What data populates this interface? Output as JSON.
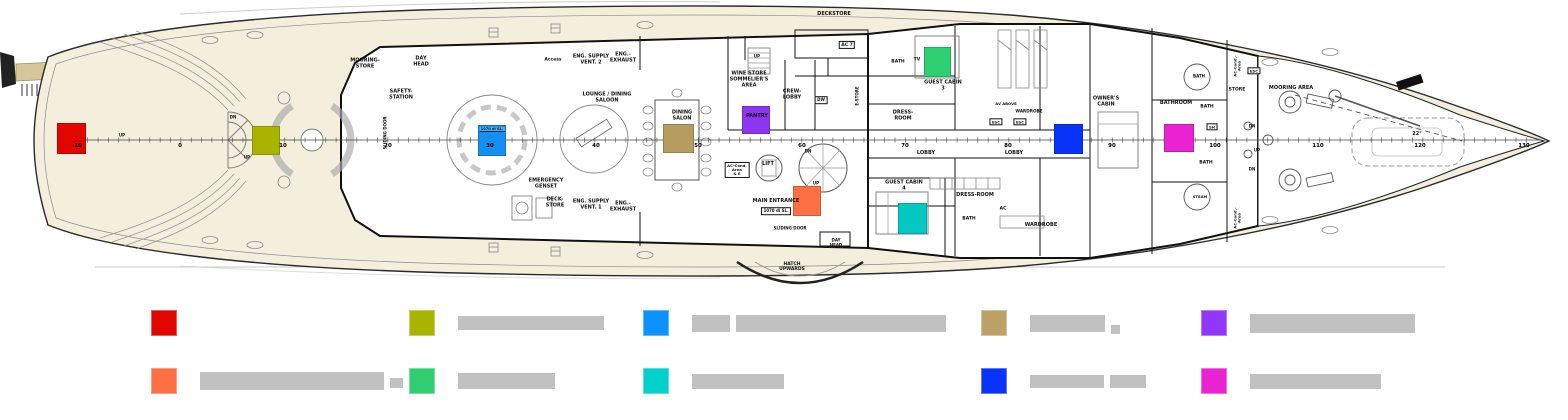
{
  "plan": {
    "deck_color": "#f4eedd",
    "gangway_color": "#d8c69b",
    "frame_numbers": [
      {
        "t": "-10",
        "x": 77
      },
      {
        "t": "0",
        "x": 180
      },
      {
        "t": "10",
        "x": 283
      },
      {
        "t": "20",
        "x": 388
      },
      {
        "t": "30",
        "x": 490
      },
      {
        "t": "40",
        "x": 596
      },
      {
        "t": "50",
        "x": 698
      },
      {
        "t": "60",
        "x": 802
      },
      {
        "t": "70",
        "x": 905
      },
      {
        "t": "80",
        "x": 1008
      },
      {
        "t": "90",
        "x": 1112
      },
      {
        "t": "100",
        "x": 1215
      },
      {
        "t": "110",
        "x": 1318
      },
      {
        "t": "120",
        "x": 1420
      },
      {
        "t": "130",
        "x": 1524
      }
    ],
    "room_labels": [
      {
        "t": "MOORING-\nSTORE",
        "x": 365,
        "y": 64
      },
      {
        "t": "DAY\nHEAD",
        "x": 421,
        "y": 62
      },
      {
        "t": "SAFETY-\nSTATION",
        "x": 401,
        "y": 95
      },
      {
        "t": "SLIDING DOOR",
        "x": 386,
        "y": 133,
        "v": true,
        "s": 4
      },
      {
        "t": "EMERGENCY\nGENSET",
        "x": 546,
        "y": 184
      },
      {
        "t": "Access",
        "x": 553,
        "y": 60,
        "s": 4.5
      },
      {
        "t": "ENG. SUPPLY\nVENT. 2",
        "x": 591,
        "y": 60
      },
      {
        "t": "ENG.-\nEXHAUST",
        "x": 623,
        "y": 58
      },
      {
        "t": "LOUNGE / DINING\nSALOON",
        "x": 607,
        "y": 98
      },
      {
        "t": "DECK-\nSTORE",
        "x": 555,
        "y": 203
      },
      {
        "t": "ENG. SUPPLY\nVENT. 1",
        "x": 591,
        "y": 205
      },
      {
        "t": "ENG.-\nEXHAUST",
        "x": 623,
        "y": 207
      },
      {
        "t": "DINING\nSALON",
        "x": 682,
        "y": 116
      },
      {
        "t": "WINE STORE\nSOMMELIER'S\nAREA",
        "x": 749,
        "y": 80
      },
      {
        "t": "PANTRY",
        "x": 757,
        "y": 117
      },
      {
        "t": "CREW-\nLOBBY",
        "x": 792,
        "y": 95
      },
      {
        "t": "DW",
        "x": 821,
        "y": 100,
        "box": true,
        "s": 4
      },
      {
        "t": "E-STORE",
        "x": 858,
        "y": 96,
        "v": true,
        "s": 4
      },
      {
        "t": "DECKSTORE",
        "x": 834,
        "y": 15
      },
      {
        "t": "AC 7",
        "x": 847,
        "y": 45,
        "box": true,
        "s": 4.5
      },
      {
        "t": "LIFT",
        "x": 768,
        "y": 165
      },
      {
        "t": "AC-Cond.\nArea\n& E",
        "x": 737,
        "y": 170,
        "s": 3.8,
        "box": true
      },
      {
        "t": "MAIN ENTRANCE",
        "x": 776,
        "y": 202
      },
      {
        "t": "1070 di SL.",
        "x": 776,
        "y": 211,
        "box": true,
        "s": 4
      },
      {
        "t": "SLIDING DOOR",
        "x": 790,
        "y": 229,
        "s": 4
      },
      {
        "t": "DAY\nHEAD",
        "x": 836,
        "y": 243,
        "s": 4
      },
      {
        "t": "HATCH\nUPWARDS",
        "x": 792,
        "y": 267,
        "s": 4.5
      },
      {
        "t": "BATH",
        "x": 898,
        "y": 62,
        "s": 4.5
      },
      {
        "t": "TV",
        "x": 917,
        "y": 60,
        "s": 4.5
      },
      {
        "t": "GUEST CABIN\n3",
        "x": 943,
        "y": 86
      },
      {
        "t": "DRESS-\nROOM",
        "x": 903,
        "y": 116
      },
      {
        "t": "LOBBY",
        "x": 926,
        "y": 154
      },
      {
        "t": "GUEST CABIN\n4",
        "x": 904,
        "y": 186
      },
      {
        "t": "DRESS-ROOM",
        "x": 975,
        "y": 196
      },
      {
        "t": "BATH",
        "x": 969,
        "y": 219,
        "s": 4.5
      },
      {
        "t": "AC",
        "x": 1003,
        "y": 209,
        "s": 4.5
      },
      {
        "t": "WARDROBE",
        "x": 1041,
        "y": 226
      },
      {
        "t": "AV ABOVE",
        "x": 1006,
        "y": 104,
        "s": 3.8
      },
      {
        "t": "WARDROBE",
        "x": 1029,
        "y": 112,
        "s": 4.2
      },
      {
        "t": "ESC",
        "x": 996,
        "y": 122,
        "box": true,
        "s": 3.8
      },
      {
        "t": "ESC",
        "x": 1020,
        "y": 122,
        "box": true,
        "s": 3.8
      },
      {
        "t": "LOBBY",
        "x": 1014,
        "y": 154
      },
      {
        "t": "OWNER'S\nCABIN",
        "x": 1106,
        "y": 102
      },
      {
        "t": "BATHROOM",
        "x": 1176,
        "y": 104
      },
      {
        "t": "BATH",
        "x": 1199,
        "y": 77,
        "s": 4
      },
      {
        "t": "BATH",
        "x": 1207,
        "y": 107,
        "s": 4.5
      },
      {
        "t": "SH",
        "x": 1212,
        "y": 127,
        "box": true,
        "s": 3.8
      },
      {
        "t": "BATH",
        "x": 1206,
        "y": 163,
        "s": 4.5
      },
      {
        "t": "STEAM",
        "x": 1200,
        "y": 197,
        "s": 3.8
      },
      {
        "t": "STORE",
        "x": 1237,
        "y": 90,
        "s": 4.5
      },
      {
        "t": "ESC",
        "x": 1254,
        "y": 71,
        "box": true,
        "s": 3.8
      },
      {
        "t": "AC-Cond.-\nArea",
        "x": 1238,
        "y": 66,
        "v": true,
        "s": 3.8
      },
      {
        "t": "AC-Cond.-\nArea",
        "x": 1238,
        "y": 218,
        "v": true,
        "s": 3.8
      },
      {
        "t": "MOORING AREA",
        "x": 1291,
        "y": 89
      },
      {
        "t": "22°",
        "x": 1417,
        "y": 135
      },
      {
        "t": "UP",
        "x": 122,
        "y": 136,
        "s": 4
      },
      {
        "t": "DN",
        "x": 233,
        "y": 118,
        "s": 4
      },
      {
        "t": "UP",
        "x": 247,
        "y": 158,
        "s": 4
      },
      {
        "t": "UP",
        "x": 757,
        "y": 57,
        "s": 4
      },
      {
        "t": "DN",
        "x": 808,
        "y": 152,
        "s": 4
      },
      {
        "t": "UP",
        "x": 816,
        "y": 184,
        "s": 4
      },
      {
        "t": "DN",
        "x": 1252,
        "y": 127,
        "s": 4
      },
      {
        "t": "UP",
        "x": 1257,
        "y": 151,
        "s": 4
      },
      {
        "t": "DN",
        "x": 1252,
        "y": 170,
        "s": 4
      }
    ],
    "markers": [
      {
        "name": "marker-red-aft-platform",
        "color": "#e10600",
        "x": 57,
        "y": 123,
        "w": 29,
        "h": 31
      },
      {
        "name": "marker-olive-aft-deck",
        "color": "#a9b400",
        "x": 252,
        "y": 126,
        "w": 28,
        "h": 29
      },
      {
        "name": "marker-blue-saloon",
        "color": "#1590f0",
        "x": 478,
        "y": 125,
        "w": 28,
        "h": 31,
        "caption": "1070 di SL."
      },
      {
        "name": "marker-tan-dining-salon",
        "color": "#b49d5f",
        "x": 663,
        "y": 124,
        "w": 31,
        "h": 29
      },
      {
        "name": "marker-purple-pantry",
        "color": "#8e35f0",
        "x": 742,
        "y": 106,
        "w": 28,
        "h": 28
      },
      {
        "name": "marker-orange-main-entrance",
        "color": "#fc7044",
        "x": 793,
        "y": 186,
        "w": 28,
        "h": 30
      },
      {
        "name": "marker-green-guest-cabin-3",
        "color": "#2ecf70",
        "x": 924,
        "y": 47,
        "w": 27,
        "h": 30
      },
      {
        "name": "marker-teal-guest-cabin-4",
        "color": "#06c8c3",
        "x": 898,
        "y": 203,
        "w": 29,
        "h": 31
      },
      {
        "name": "marker-royal-owners-lobby",
        "color": "#0833f8",
        "x": 1054,
        "y": 124,
        "w": 29,
        "h": 30
      },
      {
        "name": "marker-magenta-bathroom",
        "color": "#e922d2",
        "x": 1164,
        "y": 124,
        "w": 30,
        "h": 28
      }
    ]
  },
  "legend": {
    "bar_color": "#c1c1c1",
    "square_size": 26,
    "bar_gap": 49,
    "rows_y": [
      310,
      368
    ],
    "cols_x": [
      151,
      409,
      643,
      981,
      1201
    ],
    "items": [
      {
        "row": 0,
        "col": 0,
        "name": "legend-red",
        "color": "#e10600",
        "bars": []
      },
      {
        "row": 0,
        "col": 1,
        "name": "legend-olive",
        "color": "#a9b400",
        "bars": [
          {
            "w": 146,
            "h": 14
          }
        ]
      },
      {
        "row": 0,
        "col": 2,
        "name": "legend-blue",
        "color": "#0d92fb",
        "bars": [
          {
            "w": 38,
            "h": 17
          },
          {
            "w": 210,
            "h": 17
          }
        ]
      },
      {
        "row": 0,
        "col": 3,
        "name": "legend-tan",
        "color": "#bca266",
        "bars": [
          {
            "w": 75,
            "h": 17
          },
          {
            "w": 9,
            "h": 9,
            "dy": 6
          }
        ]
      },
      {
        "row": 0,
        "col": 4,
        "name": "legend-purple",
        "color": "#9137fb",
        "bars": [
          {
            "w": 165,
            "h": 19
          }
        ]
      },
      {
        "row": 1,
        "col": 0,
        "name": "legend-orange",
        "color": "#fc7044",
        "bars": [
          {
            "w": 184,
            "h": 18
          },
          {
            "w": 13,
            "h": 10,
            "dy": 2
          }
        ]
      },
      {
        "row": 1,
        "col": 1,
        "name": "legend-green",
        "color": "#31cd71",
        "bars": [
          {
            "w": 97,
            "h": 16
          }
        ]
      },
      {
        "row": 1,
        "col": 2,
        "name": "legend-teal",
        "color": "#02d0ca",
        "bars": [
          {
            "w": 92,
            "h": 15
          }
        ]
      },
      {
        "row": 1,
        "col": 3,
        "name": "legend-royal",
        "color": "#0833f8",
        "bars": [
          {
            "w": 74,
            "h": 13
          },
          {
            "w": 36,
            "h": 13
          }
        ]
      },
      {
        "row": 1,
        "col": 4,
        "name": "legend-magenta",
        "color": "#e922d2",
        "bars": [
          {
            "w": 131,
            "h": 15
          }
        ]
      }
    ]
  }
}
